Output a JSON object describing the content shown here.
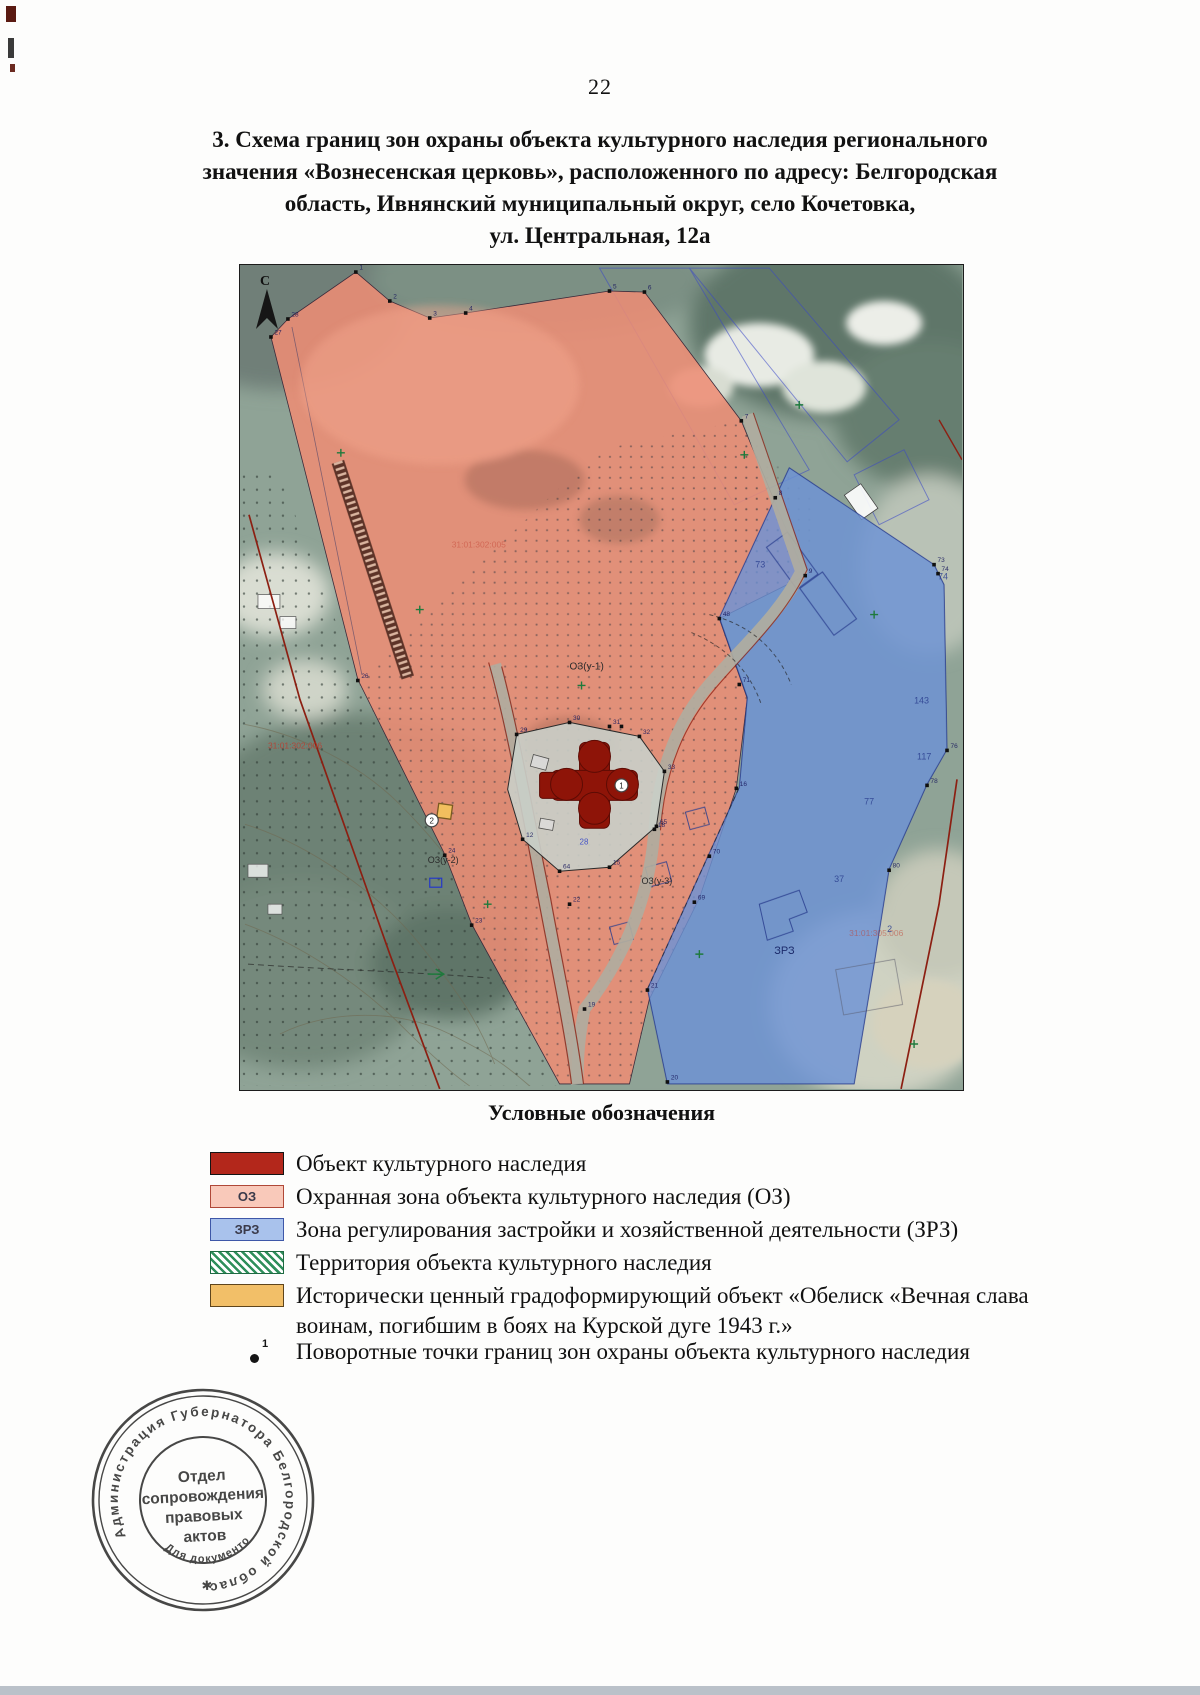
{
  "page": {
    "number": "22"
  },
  "title": {
    "lines": [
      "3. Схема границ зон охраны объекта культурного наследия регионального",
      "значения «Вознесенская церковь», расположенного по адресу: Белгородская",
      "область, Ивнянский муниципальный округ, село Кочетовка,",
      "ул. Центральная, 12а"
    ]
  },
  "map": {
    "north_label": "С",
    "zone_labels": {
      "oz1": "ОЗ(у-1)",
      "oz2": "ОЗ(у-2)",
      "oz3": "ОЗ(у-3)",
      "zrz": "ЗРЗ",
      "small_blue": "28"
    },
    "parcels": [
      {
        "x": 516,
        "y": 303,
        "t": "73"
      },
      {
        "x": 699,
        "y": 315,
        "t": "74"
      },
      {
        "x": 675,
        "y": 439,
        "t": "143"
      },
      {
        "x": 678,
        "y": 495,
        "t": "117"
      },
      {
        "x": 625,
        "y": 540,
        "t": "77"
      },
      {
        "x": 595,
        "y": 618,
        "t": "37"
      },
      {
        "x": 648,
        "y": 668,
        "t": "2"
      }
    ],
    "cadastral": [
      {
        "x": 28,
        "y": 484,
        "t": "31:01:302:006",
        "o": 0.8
      },
      {
        "x": 212,
        "y": 283,
        "t": "31:01:302:005",
        "o": 0.45
      },
      {
        "x": 610,
        "y": 672,
        "t": "31:01:305:006",
        "o": 0.5
      }
    ],
    "points": [
      {
        "x": 116,
        "y": 7,
        "n": "1"
      },
      {
        "x": 150,
        "y": 36,
        "n": "2"
      },
      {
        "x": 190,
        "y": 53,
        "n": "3"
      },
      {
        "x": 226,
        "y": 48,
        "n": "4"
      },
      {
        "x": 370,
        "y": 26,
        "n": "5"
      },
      {
        "x": 405,
        "y": 27,
        "n": "6"
      },
      {
        "x": 48,
        "y": 54,
        "n": "28"
      },
      {
        "x": 31,
        "y": 72,
        "n": "27"
      },
      {
        "x": 502,
        "y": 156,
        "n": "7"
      },
      {
        "x": 536,
        "y": 233,
        "n": "8"
      },
      {
        "x": 566,
        "y": 311,
        "n": "9"
      },
      {
        "x": 480,
        "y": 354,
        "n": "48"
      },
      {
        "x": 500,
        "y": 420,
        "n": "71"
      },
      {
        "x": 497,
        "y": 524,
        "n": "16"
      },
      {
        "x": 470,
        "y": 592,
        "n": "70"
      },
      {
        "x": 455,
        "y": 638,
        "n": "69"
      },
      {
        "x": 277,
        "y": 470,
        "n": "29"
      },
      {
        "x": 330,
        "y": 458,
        "n": "30"
      },
      {
        "x": 370,
        "y": 462,
        "n": "31"
      },
      {
        "x": 400,
        "y": 472,
        "n": "32"
      },
      {
        "x": 425,
        "y": 507,
        "n": "33"
      },
      {
        "x": 417,
        "y": 562,
        "n": "65"
      },
      {
        "x": 370,
        "y": 603,
        "n": "15"
      },
      {
        "x": 320,
        "y": 607,
        "n": "64"
      },
      {
        "x": 283,
        "y": 575,
        "n": "12"
      },
      {
        "x": 118,
        "y": 416,
        "n": "26"
      },
      {
        "x": 205,
        "y": 591,
        "n": "24"
      },
      {
        "x": 232,
        "y": 661,
        "n": "23"
      },
      {
        "x": 699,
        "y": 309,
        "n": "74"
      },
      {
        "x": 695,
        "y": 300,
        "n": "73"
      },
      {
        "x": 708,
        "y": 486,
        "n": "76"
      },
      {
        "x": 688,
        "y": 521,
        "n": "78"
      },
      {
        "x": 650,
        "y": 606,
        "n": "80"
      },
      {
        "x": 408,
        "y": 726,
        "n": "21"
      },
      {
        "x": 428,
        "y": 818,
        "n": "20"
      },
      {
        "x": 330,
        "y": 640,
        "n": "22"
      },
      {
        "x": 345,
        "y": 745,
        "n": "19"
      },
      {
        "x": 415,
        "y": 565,
        "n": "18"
      },
      {
        "x": 742,
        "y": 420,
        "n": ""
      },
      {
        "x": 382,
        "y": 462,
        "n": ""
      }
    ],
    "marker_1": "1",
    "marker_2": "2"
  },
  "legend": {
    "heading": "Условные обозначения",
    "items": [
      {
        "label": "Объект культурного наследия",
        "tag": ""
      },
      {
        "label": "Охранная зона объекта культурного наследия (ОЗ)",
        "tag": "ОЗ"
      },
      {
        "label": "Зона регулирования застройки и хозяйственной деятельности (ЗРЗ)",
        "tag": "ЗРЗ"
      },
      {
        "label": "Территория объекта культурного наследия",
        "tag": ""
      },
      {
        "label": "Исторически ценный градоформирующий объект «Обелиск «Вечная слава воинам, погибшим в боях на Курской дуге 1943 г.»",
        "tag": ""
      },
      {
        "label": "Поворотные точки границ зон охраны объекта культурного наследия",
        "tag": "1"
      }
    ]
  },
  "stamp": {
    "ring_text": "Администрация Губернатора Белгородской области",
    "center_lines": [
      "Отдел",
      "сопровождения",
      "правовых",
      "актов"
    ],
    "bottom_text": "Для документов",
    "star": "✱"
  },
  "colors": {
    "oz_pink": "#ef8d75",
    "zrz_blue": "#6d93d6",
    "heritage_red": "#8e1408",
    "legend_red": "#b3271b",
    "obelisk_orange": "#f2bf68",
    "territory_green": "#2f8f5b"
  }
}
